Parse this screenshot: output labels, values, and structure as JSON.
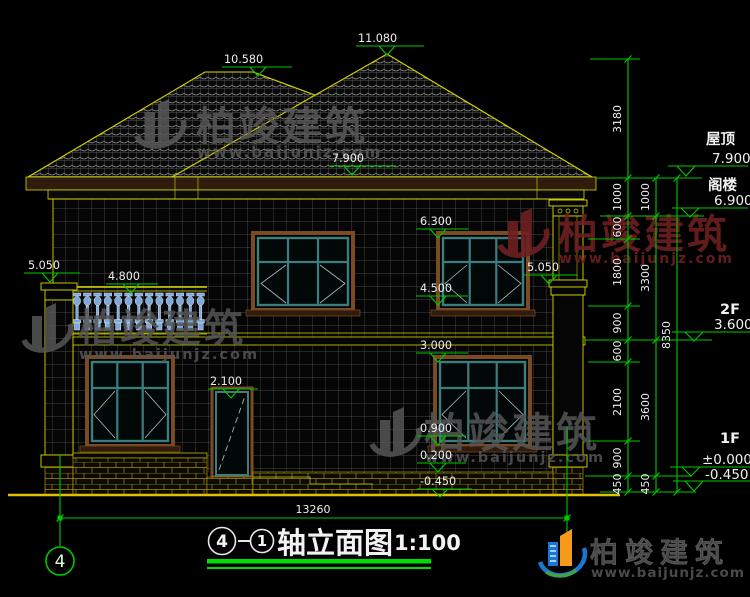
{
  "elevations": {
    "ridge_left": "10.580",
    "ridge_right": "11.080",
    "eave": "7.900",
    "w2_top": "6.300",
    "w2_sill": "4.500",
    "w1_top": "3.000",
    "w1_sill": "0.900",
    "porch": "0.200",
    "grade": "-0.450",
    "parapet_left": "5.050",
    "rail": "4.800",
    "door_top": "2.100",
    "parapet_right": "5.050"
  },
  "levels": {
    "roof": {
      "label": "屋顶",
      "value": "7.900"
    },
    "attic": {
      "label": "阁楼",
      "value": "6.900"
    },
    "f2": {
      "label": "2F",
      "value": "3.600"
    },
    "f1": {
      "label": "1F",
      "value": "±0.000"
    },
    "ground": {
      "value": "-0.450"
    }
  },
  "dims": {
    "chain_inner": [
      "3180",
      "1000",
      "600",
      "1800",
      "900",
      "600",
      "2100",
      "900",
      "450"
    ],
    "chain_mid": [
      "1000",
      "3300",
      "3600",
      "450"
    ],
    "chain_outer": [
      "8350"
    ],
    "total": "13260"
  },
  "axis": {
    "left_bubble": "4"
  },
  "title": {
    "axis_from": "4",
    "axis_to": "1",
    "text": "轴立面图",
    "scale": "1:100"
  },
  "watermark": {
    "brand": "柏竣建筑",
    "site": "www.baijunjz.com"
  },
  "logo": {
    "brand": "柏竣建筑",
    "site": "www.baijunjz.com"
  },
  "colors": {
    "annotation_green": "#00c800",
    "line_yellow": "#d8d800",
    "frame_teal": "#3c7d7d",
    "frame_brown": "#7a4a22",
    "watermark_gray": "#585858",
    "watermark_red": "#6e2020",
    "logo_blue": "#1976d2",
    "logo_orange": "#f59a1a",
    "logo_green": "#43a047"
  }
}
